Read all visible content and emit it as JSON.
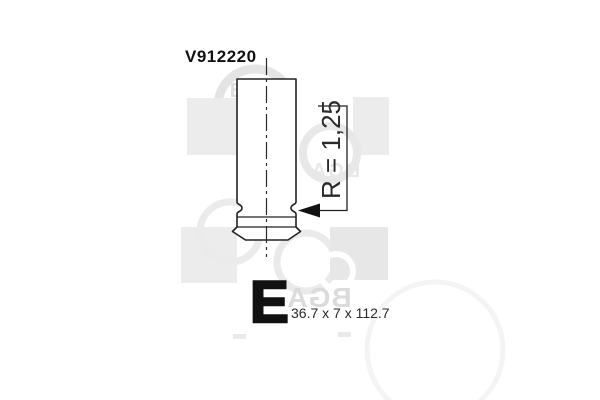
{
  "page": {
    "background": "#ffffff",
    "width": 600,
    "height": 400
  },
  "drawing": {
    "part_number": "V912220",
    "groove_radius_label": "R = 1,25",
    "valve_type_letter": "E",
    "dimensions_label": "36.7 x 7 x 112.7"
  },
  "watermark": {
    "brand": "BGA"
  },
  "colors": {
    "line": "#222222",
    "text": "#111111",
    "dim_text": "#2a2a2a",
    "watermark_light": "#e8e8e8",
    "watermark_mid": "#dbdbdb"
  }
}
